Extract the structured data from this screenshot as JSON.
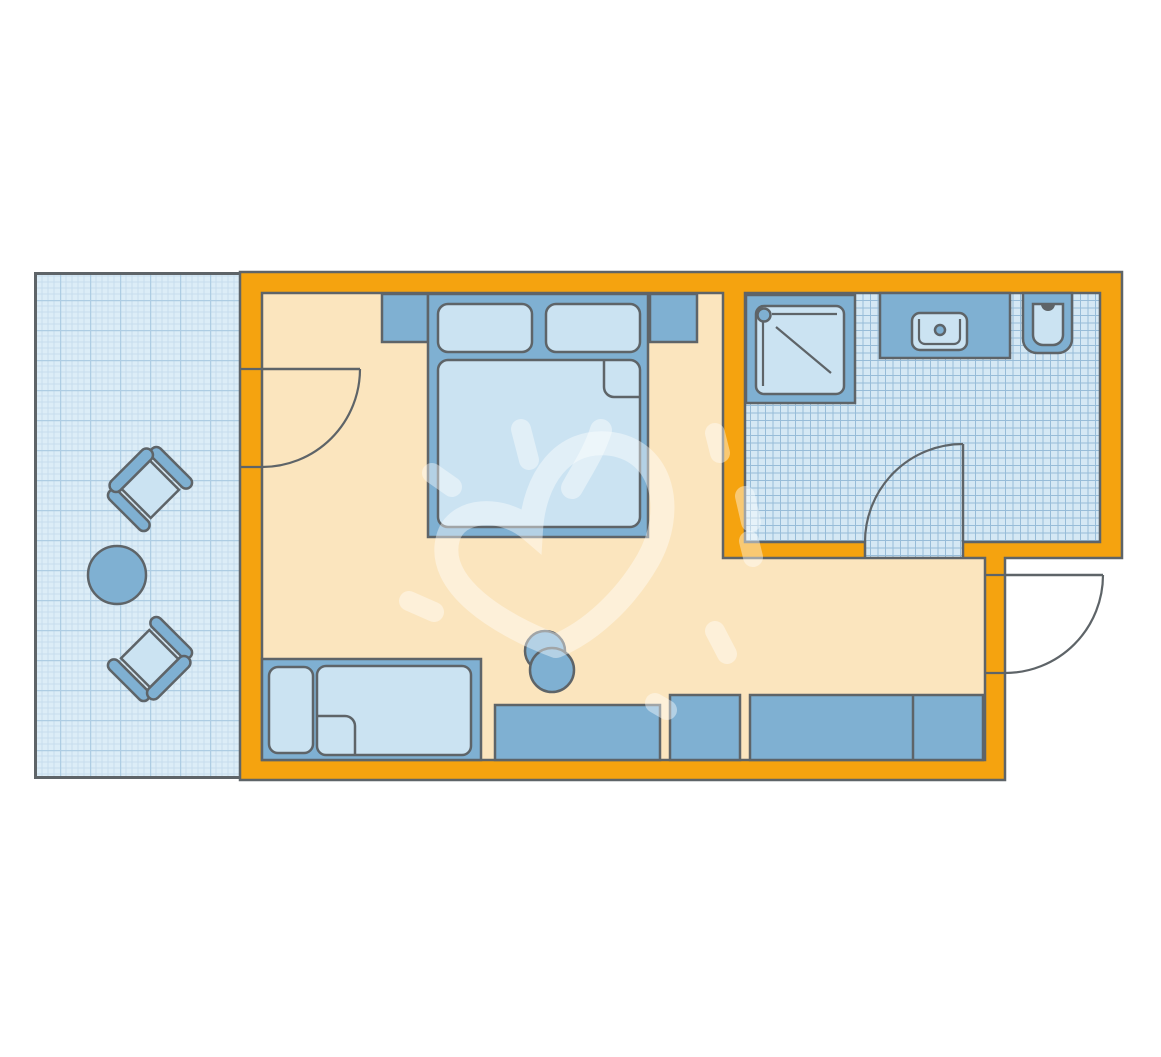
{
  "plan": {
    "kind": "hotel-room-floor-plan",
    "rooms": [
      {
        "name": "balcony",
        "floor": "grid-paper",
        "items": [
          "armchair",
          "round-table",
          "armchair"
        ]
      },
      {
        "name": "bedroom",
        "floor": "plain",
        "items": [
          "double-bed",
          "nightstand-left",
          "nightstand-right",
          "single-sofa-bed",
          "desk",
          "desk-chair",
          "cabinet",
          "wardrobe"
        ]
      },
      {
        "name": "bathroom",
        "floor": "tiles",
        "items": [
          "shower",
          "vanity-sink",
          "toilet"
        ]
      }
    ],
    "doors": [
      "balcony-door",
      "bathroom-door",
      "entrance-door"
    ],
    "watermark": "hand-drawn-heart-sun-doodle"
  },
  "colors": {
    "background": "#FFFFFF",
    "wall": "#F5A30F",
    "outline": "#5E6468",
    "floor": "#FBE5BE",
    "furniture": "#7FB0D2",
    "cushion": "#CBE3F2",
    "balcony_base": "#DCEDF7",
    "balcony_grid_minor": "#C7DDEE",
    "balcony_grid_major": "#AECDE3",
    "tile_base": "#D5E8F4",
    "tile_grid": "#97BCD8",
    "watermark": "rgba(255,255,255,0.42)"
  }
}
